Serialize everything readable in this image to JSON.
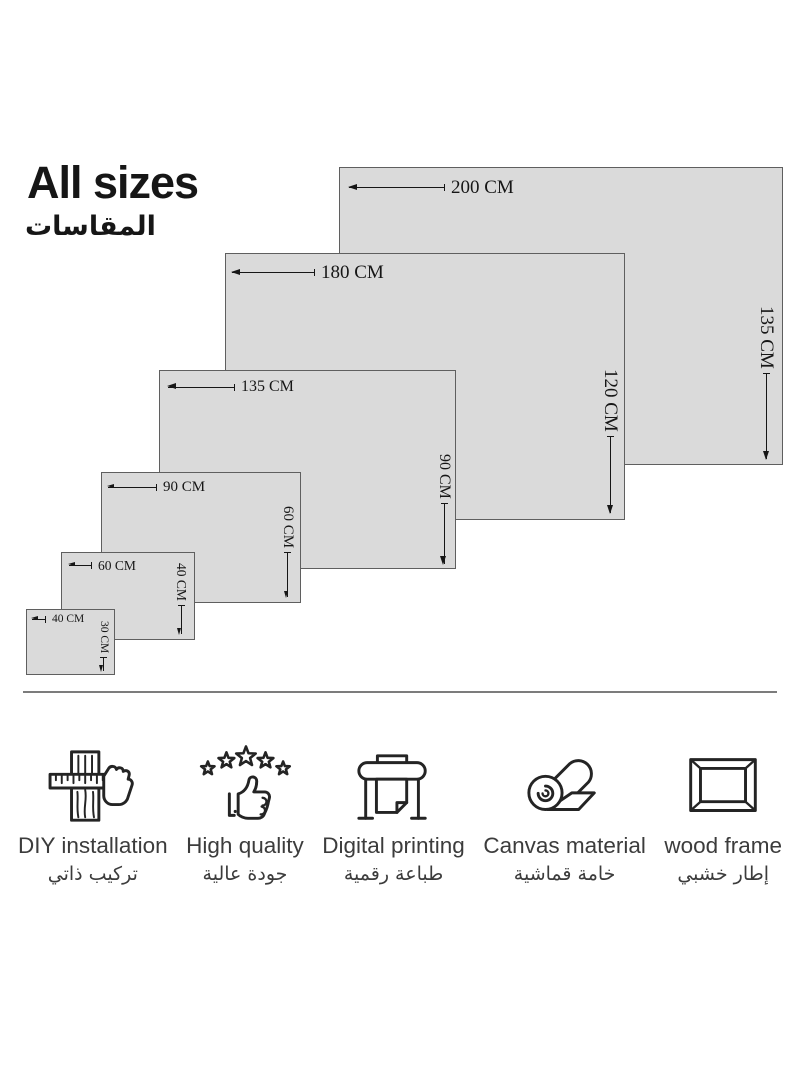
{
  "title": {
    "en": "All sizes",
    "ar": "المقاسات"
  },
  "sizes": [
    {
      "width_cm": 200,
      "height_cm": 135,
      "width_label": "200 CM",
      "height_label": "135 CM"
    },
    {
      "width_cm": 180,
      "height_cm": 120,
      "width_label": "180 CM",
      "height_label": "120 CM"
    },
    {
      "width_cm": 135,
      "height_cm": 90,
      "width_label": "135 CM",
      "height_label": "90 CM"
    },
    {
      "width_cm": 90,
      "height_cm": 60,
      "width_label": "90 CM",
      "height_label": "60 CM"
    },
    {
      "width_cm": 60,
      "height_cm": 40,
      "width_label": "60 CM",
      "height_label": "40 CM"
    },
    {
      "width_cm": 40,
      "height_cm": 30,
      "width_label": "40 CM",
      "height_label": "30 CM"
    }
  ],
  "features": [
    {
      "icon": "measuring-tape-icon",
      "label_en": "DIY installation",
      "label_ar": "تركيب ذاتي"
    },
    {
      "icon": "stars-thumbs-up-icon",
      "label_en": "High quality",
      "label_ar": "جودة عالية"
    },
    {
      "icon": "large-format-printer-icon",
      "label_en": "Digital printing",
      "label_ar": "طباعة رقمية"
    },
    {
      "icon": "canvas-roll-icon",
      "label_en": "Canvas material",
      "label_ar": "خامة قماشية"
    },
    {
      "icon": "wood-frame-icon",
      "label_en": "wood frame",
      "label_ar": "إطار خشبي"
    }
  ],
  "colors": {
    "panel_fill": "#dadada",
    "panel_border": "#5f5f5f",
    "dimension_text": "#161616",
    "divider": "#7c7c7c",
    "feature_text": "#3c3c3c"
  }
}
